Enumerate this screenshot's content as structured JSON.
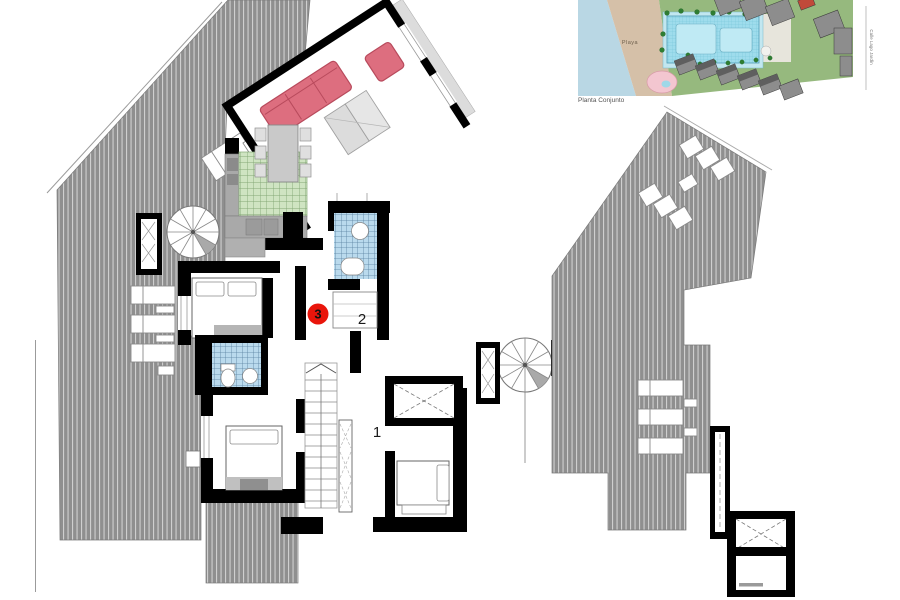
{
  "floor_plan": {
    "unit_badge": "3",
    "label_2": "2",
    "label_1": "1"
  },
  "inset": {
    "caption": "Planta Conjunto",
    "beach_label": "Playa",
    "street_label": "Calle Lago Jardín"
  },
  "colors": {
    "badge_red": "#e9150b",
    "wall_black": "#000000",
    "terrace_hatch_gray": "#8f8f8f",
    "kitchen_tile_green": "#cfe4c2",
    "bath_tile_blue": "#badaed",
    "sofa_pink": "#dd6e7f",
    "inset_sea_blue": "#b9d7e4",
    "inset_sand": "#d5c0a8",
    "inset_grass_green": "#96b97e",
    "inset_pool_cyan": "#9edcec",
    "inset_building_gray": "#8d8d8d",
    "inset_kids_pool_pink": "#f3c6d0"
  }
}
